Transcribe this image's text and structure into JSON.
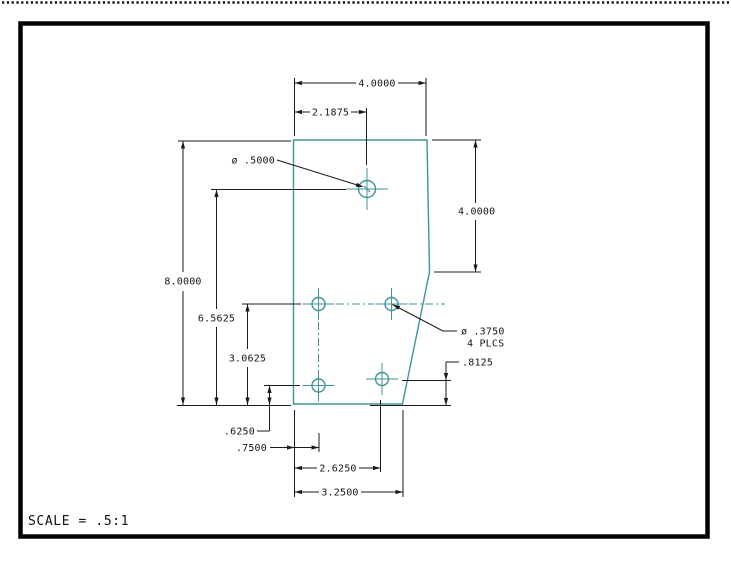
{
  "window": {
    "scale_note": "SCALE = .5:1"
  },
  "dimensions": {
    "overall_width": "4.0000",
    "large_hole_offset_x": "2.1875",
    "large_hole_diameter": "ø .5000",
    "right_edge_height": "4.0000",
    "overall_height": "8.0000",
    "mid_hole_row_height": "6.5625",
    "lower_hole_row_height": "3.0625",
    "small_hole_diameter": "ø .3750",
    "small_hole_places": "4 PLCS",
    "lower_right_hole_height": ".8125",
    "lower_left_hole_height": ".6250",
    "lower_left_hole_offset_x": ".7500",
    "lower_right_hole_offset_x": "2.6250",
    "bottom_corner_offset_x": "3.2500"
  },
  "colors": {
    "part_line": "#3f949b",
    "dimension_line": "#1a1a1a",
    "frame": "#000000",
    "background": "#ffffff"
  }
}
